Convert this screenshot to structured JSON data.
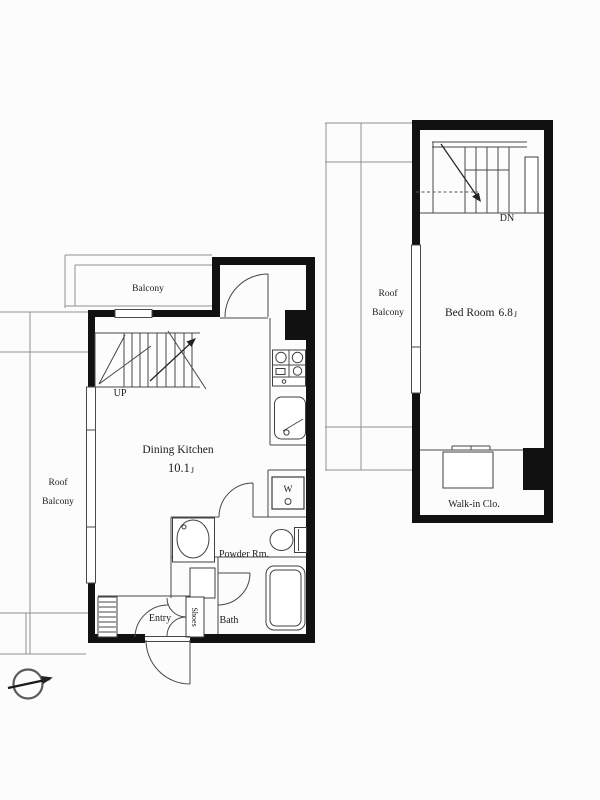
{
  "floor1": {
    "balcony_label": "Balcony",
    "roof_balcony": {
      "line1": "Roof",
      "line2": "Balcony"
    },
    "stairs_label": "UP",
    "room": {
      "name": "Dining Kitchen",
      "size": "10.1",
      "unit": "J"
    },
    "washer_label": "W",
    "powder_room_label": "Powder Rm.",
    "bath_label": "Bath",
    "entry_label": "Entry",
    "shoes_label": "Shoes"
  },
  "floor2": {
    "roof_balcony": {
      "line1": "Roof",
      "line2": "Balcony"
    },
    "stairs_label": "DN",
    "room": {
      "name": "Bed Room",
      "size": "6.8",
      "unit": "J"
    },
    "closet_label": "Walk-in Clo."
  },
  "colors": {
    "wall": "#111111",
    "thin_line": "#474747",
    "light_line": "#8f8f8f",
    "text": "#1c1c1c",
    "background": "#fcfcfc"
  }
}
